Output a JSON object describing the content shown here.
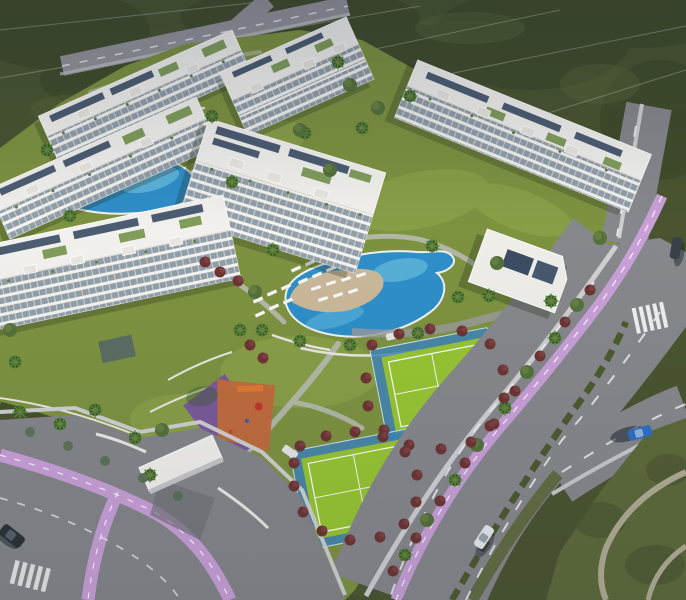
{
  "scene": {
    "type": "aerial-architectural-render",
    "title": "Aerial dusk render of a residential resort complex",
    "description": "Dusk aerial CGI view of a white low-rise apartment complex with rooftop gardens and solar panels, two free-form blue swimming pools with white sun loungers, two bright-green padel courts ringed by red shrubs, an orange and purple children's playground, landscaped lawns with palm trees, perimeter asphalt roads with lavender bike lanes, crosswalks, a few cars, and dark scrubland beyond."
  },
  "palette": {
    "scrub": "#4a5530",
    "scrub_light": "#5d6a3a",
    "lawn": "#7e9340",
    "lawn_light": "#95aa4e",
    "asphalt": "#87888c",
    "asphalt_light": "#94959a",
    "sidewalk": "#cfd0d2",
    "marking": "#f2f2f2",
    "bike_lane": "#c9a0d8",
    "building": "#f2f1ed",
    "shadow": "#26301c",
    "solar": "#3e4f66",
    "roof_garden": "#74934a",
    "pool": "#2f8fc9",
    "pool_light": "#7fd0e8",
    "sand": "#cbb89a",
    "court": "#97c632",
    "court_apron": "#3f86b8",
    "shrub_red": "#6d3434",
    "palm": "#46702f",
    "tree": "#55713a",
    "playground_orange": "#c06c3c",
    "playground_purple": "#7a55a0",
    "wall": "#eceae4",
    "sand_path": "#b0ac94",
    "hedge": "#44512a",
    "car_dark": "#2b3138",
    "car_white": "#e8eaec",
    "car_blue": "#2f6fc4",
    "car_gray": "#3a414b"
  },
  "inventory": {
    "apartment_buildings": 6,
    "clubhouse": 1,
    "swimming_pools": 2,
    "padel_courts": 2,
    "playgrounds": 1,
    "cars_visible": 6,
    "crosswalks": 2,
    "has_bike_lanes": true,
    "has_rooftop_solar": true
  }
}
